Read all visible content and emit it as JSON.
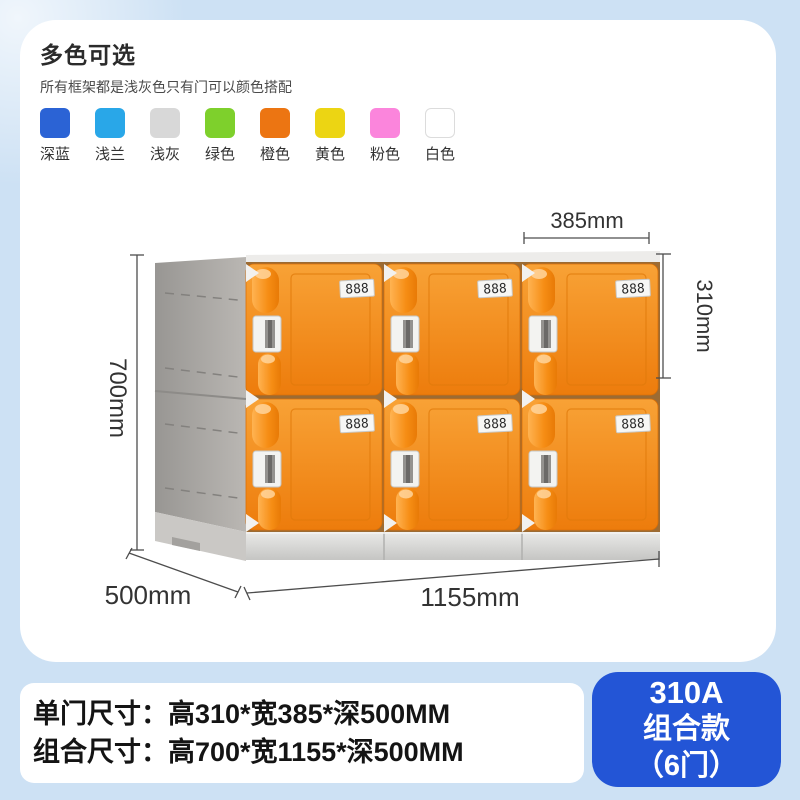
{
  "page": {
    "background_color": "#cde1f4"
  },
  "color_panel": {
    "title": "多色可选",
    "subtitle": "所有框架都是浅灰色只有门可以颜色搭配",
    "items": [
      {
        "label": "深蓝",
        "hex": "#2b63d5"
      },
      {
        "label": "浅兰",
        "hex": "#29a7e8"
      },
      {
        "label": "浅灰",
        "hex": "#d8d8d8"
      },
      {
        "label": "绿色",
        "hex": "#7ed02c"
      },
      {
        "label": "橙色",
        "hex": "#ec7512"
      },
      {
        "label": "黄色",
        "hex": "#ecd513"
      },
      {
        "label": "粉色",
        "hex": "#fb85dc"
      },
      {
        "label": "白色",
        "hex": "#ffffff"
      }
    ]
  },
  "locker": {
    "rows": 2,
    "columns": 3,
    "door_label": "888",
    "door_color": "#f18a1a",
    "frame_color": "#b3b0ac"
  },
  "dimensions": {
    "door_width": "385mm",
    "door_height": "310mm",
    "total_height": "700mm",
    "depth": "500mm",
    "total_width": "1155mm"
  },
  "specs": {
    "line1": "单门尺寸：高310*宽385*深500MM",
    "line2": "组合尺寸：高700*宽1155*深500MM"
  },
  "badge": {
    "model": "310A",
    "series": "组合款",
    "doors": "（6门）",
    "background": "#2355d6"
  }
}
